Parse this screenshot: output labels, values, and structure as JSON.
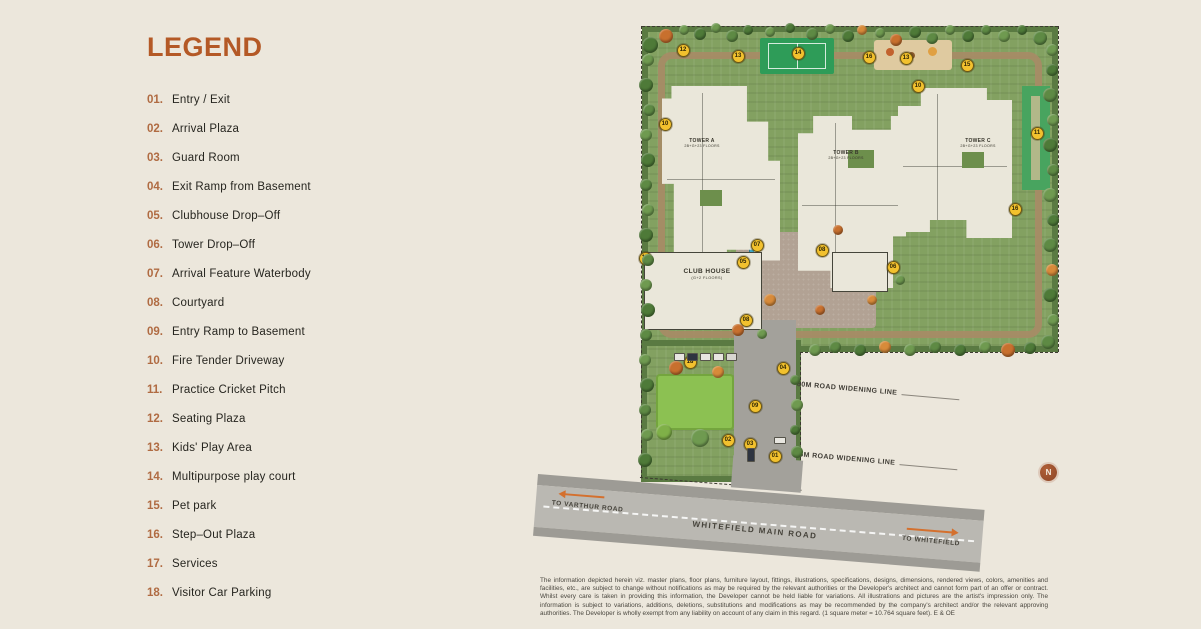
{
  "colors": {
    "accent": "#b45926",
    "marker_yellow": "#f2c12e",
    "arrow_orange": "#d4702e",
    "road_gray": "#bab8b2",
    "site_green": "#83a161",
    "background_cream": "#ece7dc"
  },
  "legend": {
    "title": "LEGEND",
    "items": [
      {
        "num": "01.",
        "label": "Entry / Exit"
      },
      {
        "num": "02.",
        "label": "Arrival Plaza"
      },
      {
        "num": "03.",
        "label": "Guard Room"
      },
      {
        "num": "04.",
        "label": "Exit Ramp from Basement"
      },
      {
        "num": "05.",
        "label": "Clubhouse Drop–Off"
      },
      {
        "num": "06.",
        "label": "Tower Drop–Off"
      },
      {
        "num": "07.",
        "label": "Arrival Feature Waterbody"
      },
      {
        "num": "08.",
        "label": "Courtyard"
      },
      {
        "num": "09.",
        "label": "Entry Ramp to Basement"
      },
      {
        "num": "10.",
        "label": "Fire Tender Driveway"
      },
      {
        "num": "11.",
        "label": "Practice Cricket Pitch"
      },
      {
        "num": "12.",
        "label": "Seating Plaza"
      },
      {
        "num": "13.",
        "label": "Kids' Play Area"
      },
      {
        "num": "14.",
        "label": "Multipurpose play court"
      },
      {
        "num": "15.",
        "label": "Pet park"
      },
      {
        "num": "16.",
        "label": "Step–Out Plaza"
      },
      {
        "num": "17.",
        "label": "Services"
      },
      {
        "num": "18.",
        "label": "Visitor Car Parking"
      }
    ]
  },
  "plan": {
    "towers": [
      {
        "name": "TOWER A",
        "floors": "2B+G+23 FLOORS"
      },
      {
        "name": "TOWER B",
        "floors": "2B+G+23 FLOORS"
      },
      {
        "name": "TOWER C",
        "floors": "2B+G+23 FLOORS"
      }
    ],
    "clubhouse": {
      "name": "CLUB HOUSE",
      "floors": "(G+2 FLOORS)"
    },
    "labels": {
      "widening80": "80M ROAD WIDENING LINE",
      "widening45": "45M ROAD WIDENING LINE",
      "mainRoad": "WHITEFIELD MAIN ROAD",
      "toLeft": "TO VARTHUR ROAD",
      "toRight": "TO WHITEFIELD",
      "compass": "N"
    },
    "markers": [
      {
        "n": "12",
        "x": 683,
        "y": 50
      },
      {
        "n": "13",
        "x": 738,
        "y": 56
      },
      {
        "n": "14",
        "x": 798,
        "y": 53
      },
      {
        "n": "16",
        "x": 869,
        "y": 57
      },
      {
        "n": "13",
        "x": 906,
        "y": 58
      },
      {
        "n": "15",
        "x": 967,
        "y": 65
      },
      {
        "n": "10",
        "x": 918,
        "y": 86
      },
      {
        "n": "11",
        "x": 1037,
        "y": 133
      },
      {
        "n": "10",
        "x": 665,
        "y": 124
      },
      {
        "n": "17",
        "x": 645,
        "y": 258
      },
      {
        "n": "07",
        "x": 757,
        "y": 245
      },
      {
        "n": "05",
        "x": 743,
        "y": 262
      },
      {
        "n": "08",
        "x": 822,
        "y": 250
      },
      {
        "n": "06",
        "x": 893,
        "y": 267
      },
      {
        "n": "16",
        "x": 1015,
        "y": 209
      },
      {
        "n": "08",
        "x": 746,
        "y": 320
      },
      {
        "n": "18",
        "x": 690,
        "y": 362
      },
      {
        "n": "04",
        "x": 783,
        "y": 368
      },
      {
        "n": "09",
        "x": 755,
        "y": 406
      },
      {
        "n": "02",
        "x": 728,
        "y": 440
      },
      {
        "n": "03",
        "x": 750,
        "y": 444
      },
      {
        "n": "01",
        "x": 775,
        "y": 456
      }
    ]
  },
  "disclaimer": {
    "lines": [
      "The information depicted herein viz. master plans, floor plans, furniture layout, fittings, illustrations, specifications, designs, dimensions, rendered views, colors, amenities and facilities, etc., are subject to change",
      "without notifications as may be required by the relevant authorities or the Developer's architect and cannot form part of an offer or contract. Whilst every care is taken in providing this information, the Developer",
      "cannot be held liable for variations. All illustrations and pictures are the artist's impression only. The information is subject to variations, additions, deletions, substitutions and modifications as may be recommended",
      "by the company's architect and/or the relevant approving authorities. The Developer is wholly exempt from any liability on account of any claim in this regard. (1 square meter = 10.764 square feet). E & OE"
    ]
  }
}
